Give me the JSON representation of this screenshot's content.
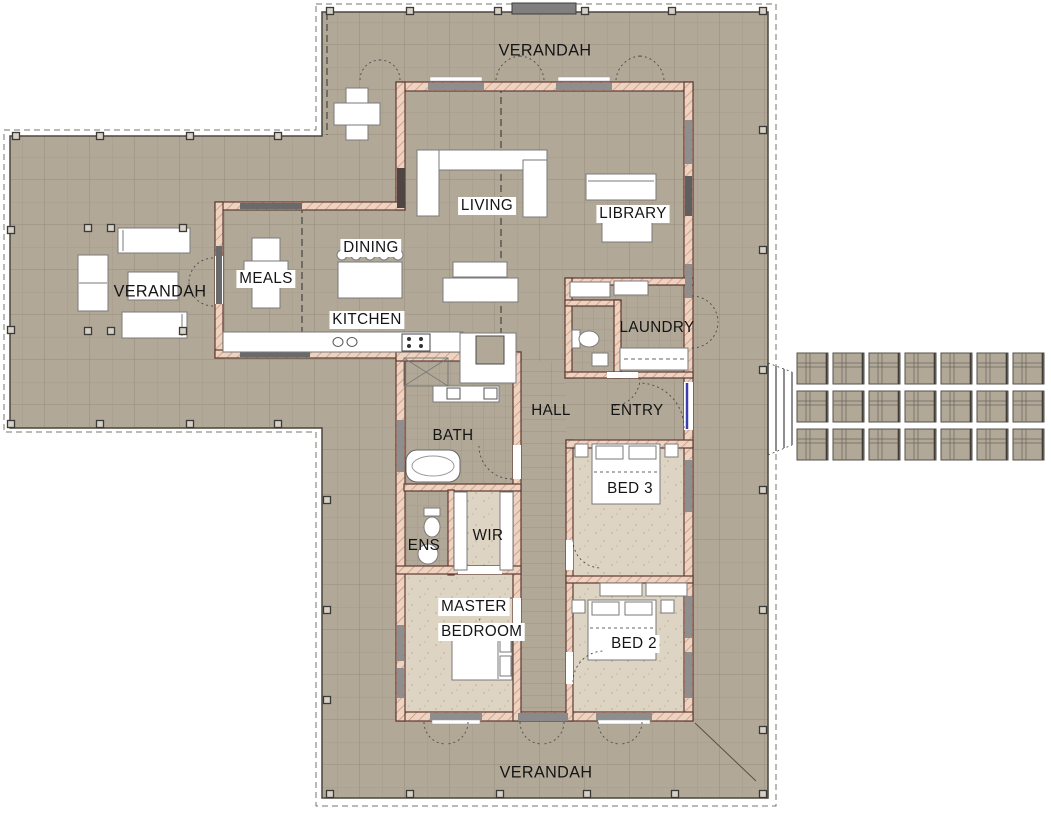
{
  "document": {
    "type": "residential floor plan",
    "rooms": {
      "verandah_top": "VERANDAH",
      "verandah_left": "VERANDAH",
      "verandah_bottom": "VERANDAH",
      "meals": "MEALS",
      "dining": "DINING",
      "kitchen": "KITCHEN",
      "living": "LIVING",
      "library": "LIBRARY",
      "laundry": "LAUNDRY",
      "entry": "ENTRY",
      "hall": "HALL",
      "bath": "BATH",
      "ens": "ENS",
      "wir": "WIR",
      "master_line1": "MASTER",
      "master_line2": "BEDROOM",
      "bed3": "BED 3",
      "bed2": "BED 2"
    },
    "colors": {
      "deck_floor": "#b1a898",
      "grid_line": "#978c7b",
      "carpet": "#ded4c4",
      "wall_fill": "#eed3c1",
      "wall_stroke": "#5e3a33",
      "window_gray": "#8e8e8e",
      "dark_window": "#6a6a6a",
      "front_door_blue": "#3a3fae",
      "paver_line": "#55504a",
      "step_gray": "#7f7f7f",
      "furniture": "#ffffff"
    },
    "paver_grid": {
      "columns": 7,
      "rows": 3
    }
  }
}
